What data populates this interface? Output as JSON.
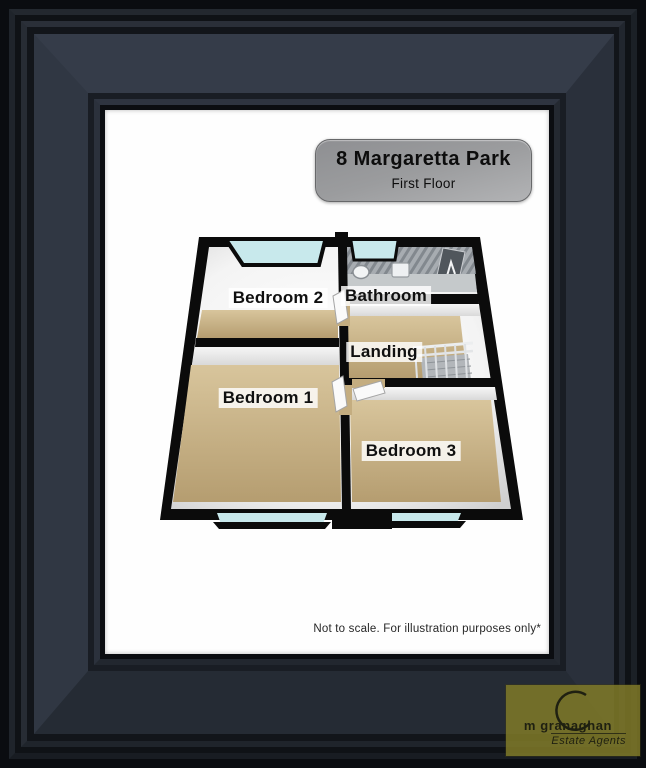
{
  "plaque": {
    "title": "8 Margaretta Park",
    "subtitle": "First Floor"
  },
  "plan": {
    "rooms": [
      {
        "id": "bedroom2",
        "label": "Bedroom 2"
      },
      {
        "id": "bathroom",
        "label": "Bathroom"
      },
      {
        "id": "landing",
        "label": "Landing"
      },
      {
        "id": "bedroom1",
        "label": "Bedroom 1"
      },
      {
        "id": "bedroom3",
        "label": "Bedroom 3"
      }
    ]
  },
  "footer": {
    "disclaimer": "Not to scale. For illustration purposes only*"
  },
  "logo": {
    "name": "m granaghan",
    "tagline": "Estate Agents"
  },
  "colors": {
    "frame_band": "#2d333e",
    "mat": "#fefefe",
    "wall": "#0b0b0b",
    "floor_tan": "#c9b183",
    "window_glass": "#c8e9ec",
    "bathroom_floor": "#c5c9cb",
    "plaque_gray": "#9b9c9e",
    "logo_olive": "#807a28"
  }
}
